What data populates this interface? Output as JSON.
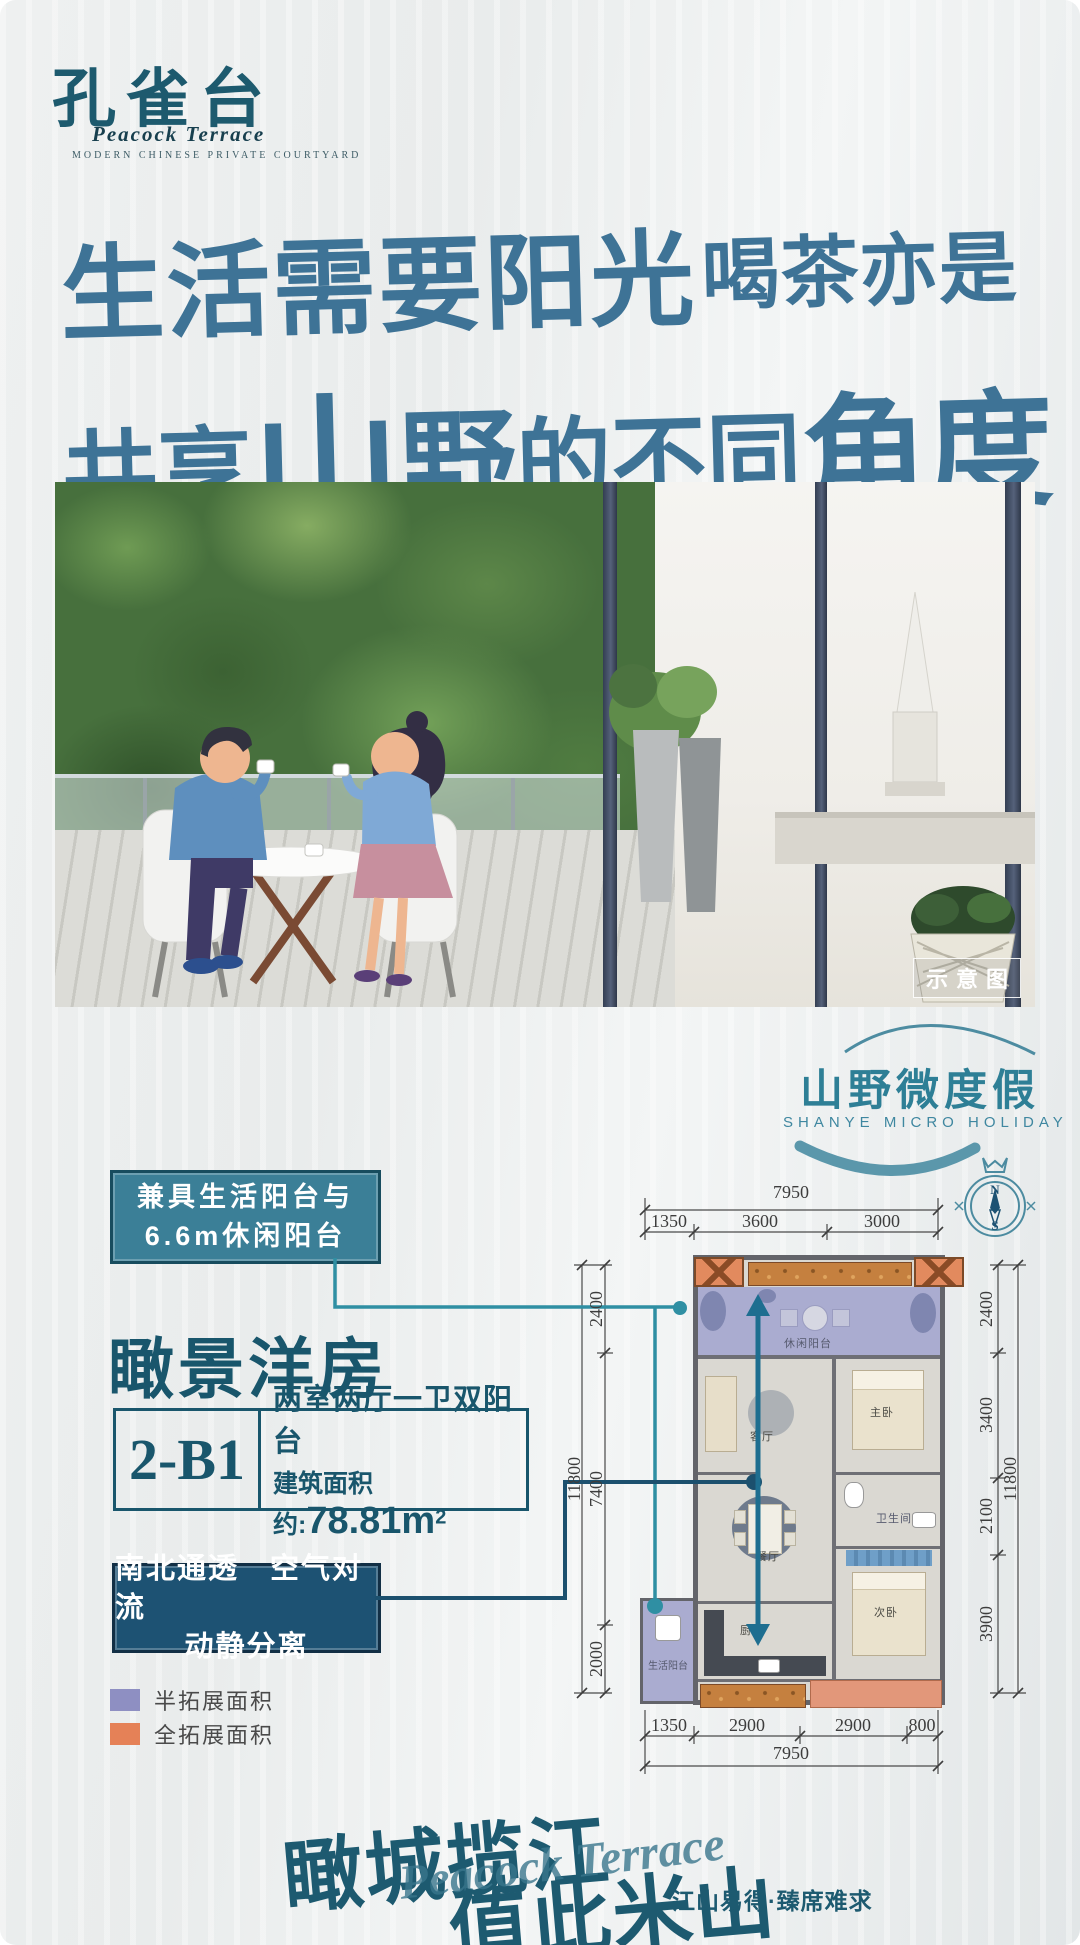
{
  "colors": {
    "accent_teal": "#2e7f96",
    "dark_teal": "#1d5a70",
    "headline_blue": "#3e7396",
    "callout_fill": "#3b7f97",
    "navy_box": "#1d5273",
    "leader_teal": "#2f8fa3",
    "leader_navy": "#1c506e",
    "legend_half_purple": "#8e8fc2",
    "legend_full_orange": "#e58157",
    "balcony_lavender": "#aaacd0",
    "extension_salmon": "#e2977a",
    "planter_orange": "#c5803f"
  },
  "logo": {
    "name_cn": "孔雀台",
    "name_en": "Peacock Terrace",
    "subtitle": "MODERN CHINESE PRIVATE COURTYARD"
  },
  "headline": {
    "part1": "生活需要阳光",
    "part2": "喝茶亦是",
    "part3": "共享",
    "part4": "山",
    "part5": "野",
    "part6": "的不同",
    "part7": "角度"
  },
  "photo": {
    "watermark": "示意图"
  },
  "holiday": {
    "title": "山野微度假",
    "subtitle": "SHANYE MICRO HOLIDAY"
  },
  "callout_balcony": {
    "line1": "兼具生活阳台与",
    "line2": "6.6m休闲阳台"
  },
  "product": {
    "title": "瞰景洋房",
    "unit": "2-B1",
    "layout": "两室两厅一卫双阳台",
    "area_label": "建筑面积约:",
    "area_value": "78.81m",
    "area_sup": "2"
  },
  "callout_vent": {
    "line1": "南北通透　空气对流",
    "line2": "动静分离"
  },
  "legend": [
    {
      "label": "半拓展面积"
    },
    {
      "label": "全拓展面积"
    }
  ],
  "floorplan": {
    "compass": {
      "north": "N",
      "south": "S"
    },
    "rooms": {
      "leisure_balcony": "休闲阳台",
      "living": "客厅",
      "master": "主卧",
      "dining": "餐厅",
      "bath": "卫生间",
      "kitchen": "厨房",
      "second_bed": "次卧",
      "life_balcony": "生活阳台"
    },
    "dims": {
      "top_total": "7950",
      "top_segments": [
        "1350",
        "3600",
        "3000"
      ],
      "bottom_total": "7950",
      "bottom_segments": [
        "1350",
        "2900",
        "2900",
        "800"
      ],
      "left_total": "11800",
      "left_segments": [
        "2400",
        "7400",
        "2000"
      ],
      "right_total": "11800",
      "right_segments": [
        "2400",
        "3400",
        "2100",
        "3900"
      ]
    }
  },
  "footer": {
    "slogan_a": "瞰城揽江",
    "slogan_b": "值此米山",
    "script": "Peacock Terrace",
    "tagline": "江山易得·臻席难求"
  }
}
